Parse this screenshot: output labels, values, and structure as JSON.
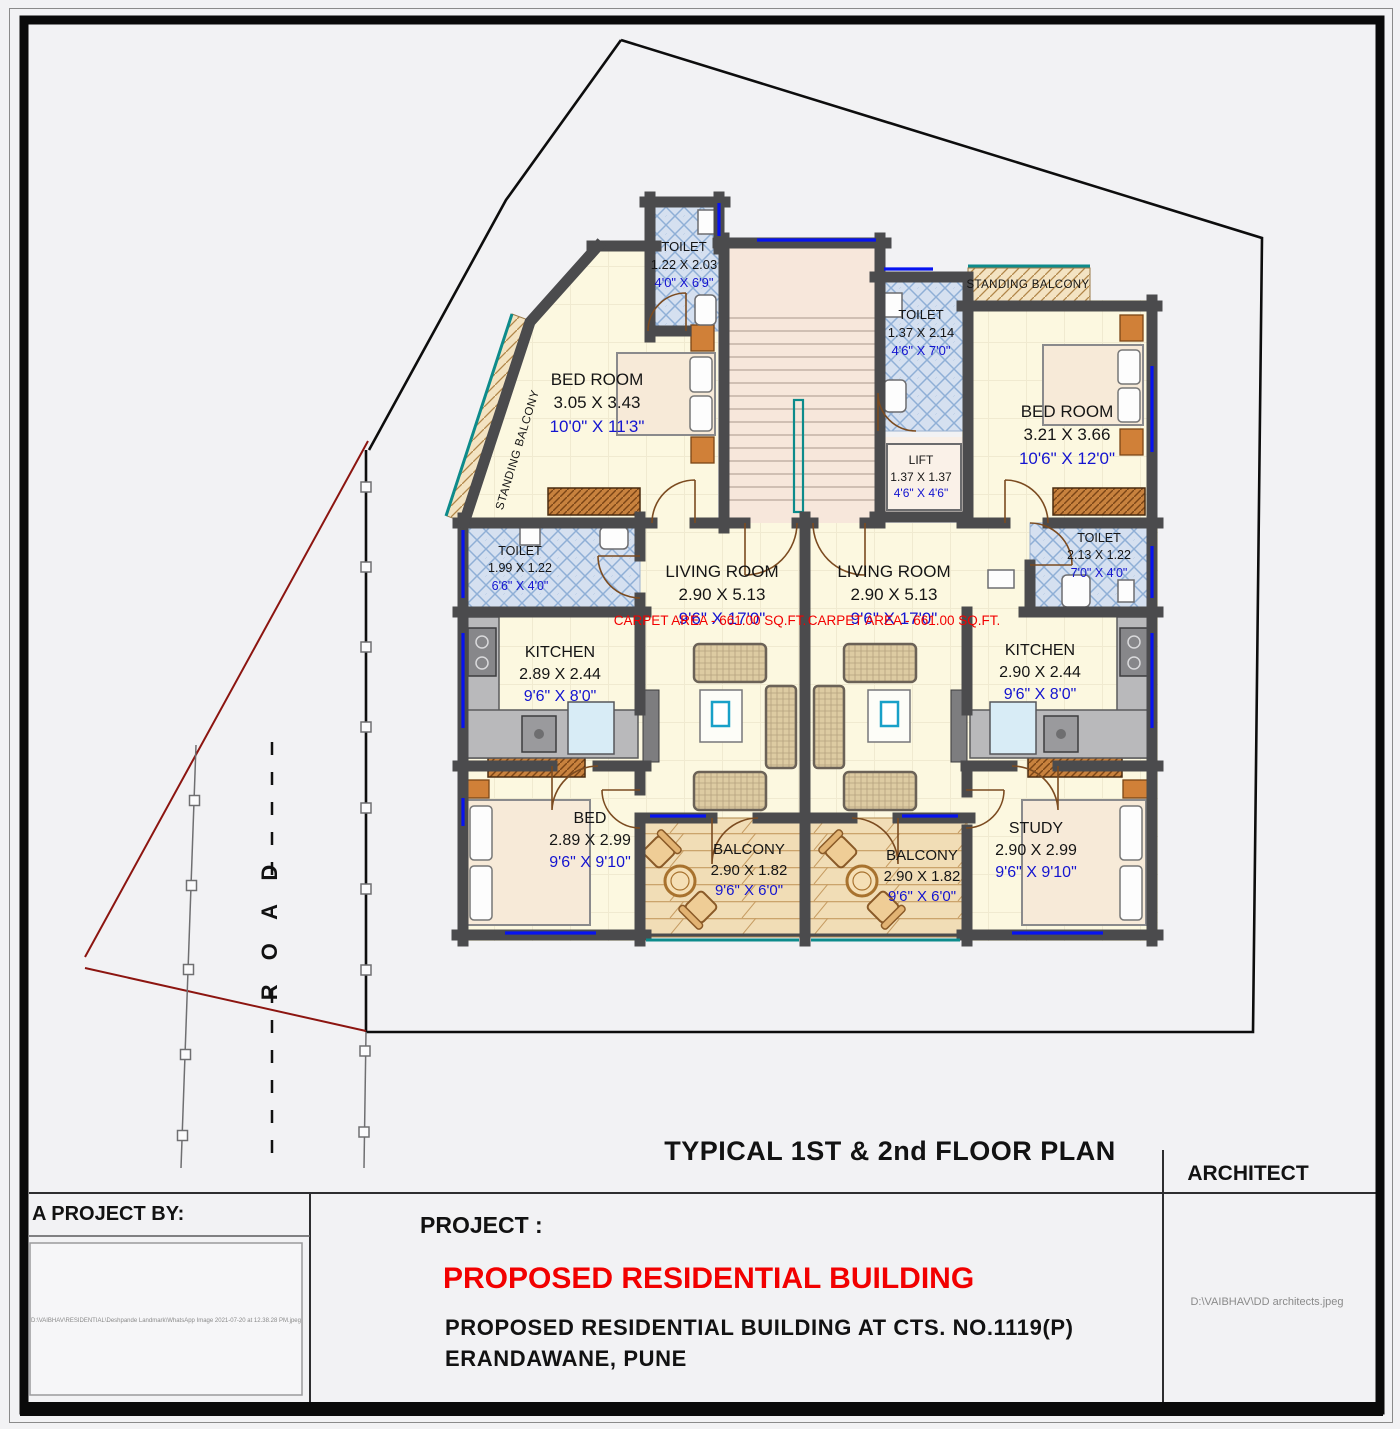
{
  "colors": {
    "wall": "#4b4b4d",
    "window_blue": "#0713f0",
    "railing_teal": "#0d8b8b",
    "floor_cream": "#fcf8e0",
    "toilet_blue": "#d5e0f0",
    "stair_pink": "#f7e7db",
    "balcony_tan": "#f1ddb6",
    "carpet_red": "#f20000",
    "dimension_blue": "#1414d0",
    "site_line_red": "#8c1510"
  },
  "site": {
    "road_label": "R O A D"
  },
  "titles": {
    "plan_title": "TYPICAL 1ST & 2nd FLOOR PLAN",
    "architect_label": "ARCHITECT",
    "architect_file": "D:\\VAIBHAV\\DD architects.jpeg",
    "project_by_label": "A PROJECT BY:",
    "project_by_file": "D:\\VAIBHAV\\RESIDENTIAL\\Deshpande Landmark\\WhatsApp Image 2021-07-20 at 12.38.28 PM.jpeg",
    "project_label": "PROJECT :",
    "project_name": "PROPOSED RESIDENTIAL BUILDING",
    "project_address1": "PROPOSED RESIDENTIAL BUILDING AT CTS. NO.1119(P)",
    "project_address2": "ERANDAWANE, PUNE"
  },
  "rooms": {
    "toilet_top_left": {
      "name": "TOILET",
      "metric": "1.22 X 2.03",
      "imperial": "4'0\" X 6'9\""
    },
    "toilet_top_right": {
      "name": "TOILET",
      "metric": "1.37 X 2.14",
      "imperial": "4'6\" X 7'0\""
    },
    "bedroom_left": {
      "name": "BED ROOM",
      "metric": "3.05 X 3.43",
      "imperial": "10'0\" X 11'3\""
    },
    "bedroom_right": {
      "name": "BED ROOM",
      "metric": "3.21 X 3.66",
      "imperial": "10'6\" X 12'0\""
    },
    "standing_balcony_left": {
      "name": "STANDING BALCONY"
    },
    "standing_balcony_right": {
      "name": "STANDING BALCONY"
    },
    "lift": {
      "name": "LIFT",
      "metric": "1.37 X 1.37",
      "imperial": "4'6\" X 4'6\""
    },
    "toilet_mid_left": {
      "name": "TOILET",
      "metric": "1.99 X 1.22",
      "imperial": "6'6\" X 4'0\""
    },
    "toilet_mid_right": {
      "name": "TOILET",
      "metric": "2.13 X 1.22",
      "imperial": "7'0\" X 4'0\""
    },
    "living_left": {
      "name": "LIVING ROOM",
      "metric": "2.90 X 5.13",
      "imperial": "9'6\" X 17'0\"",
      "carpet": "CARPET AREA - 661.00 SQ.FT."
    },
    "living_right": {
      "name": "LIVING ROOM",
      "metric": "2.90 X 5.13",
      "imperial": "9'6\" X 17'0\"",
      "carpet": "CARPET AREA - 661.00 SQ.FT."
    },
    "kitchen_left": {
      "name": "KITCHEN",
      "metric": "2.89 X 2.44",
      "imperial": "9'6\" X 8'0\""
    },
    "kitchen_right": {
      "name": "KITCHEN",
      "metric": "2.90 X 2.44",
      "imperial": "9'6\" X 8'0\""
    },
    "bed_left": {
      "name": "BED",
      "metric": "2.89 X 2.99",
      "imperial": "9'6\" X 9'10\""
    },
    "study_right": {
      "name": "STUDY",
      "metric": "2.90 X 2.99",
      "imperial": "9'6\" X 9'10\""
    },
    "balcony_left": {
      "name": "BALCONY",
      "metric": "2.90 X 1.82",
      "imperial": "9'6\" X 6'0\""
    },
    "balcony_right": {
      "name": "BALCONY",
      "metric": "2.90 X 1.82",
      "imperial": "9'6\" X 6'0\""
    }
  }
}
